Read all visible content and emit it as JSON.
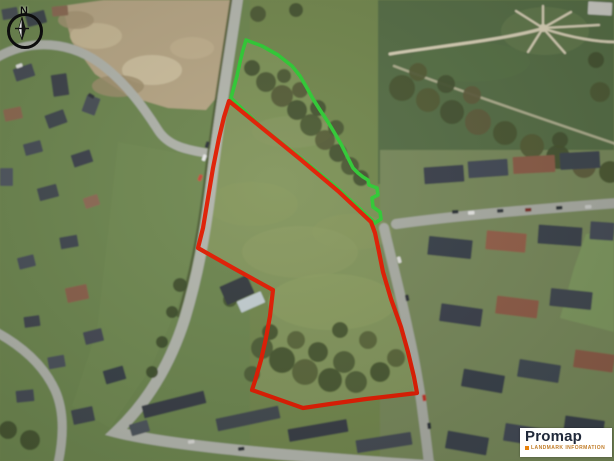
{
  "map": {
    "compass_label": "N",
    "attribution": {
      "brand": "Promap",
      "tagline": "LANDMARK INFORMATION"
    }
  },
  "overlay": {
    "boundaries": [
      {
        "name": "extension-boundary-green",
        "color": "#2ecc33",
        "stroke_width": 3.6,
        "points": [
          [
            246,
            40
          ],
          [
            262,
            46
          ],
          [
            278,
            55
          ],
          [
            292,
            66
          ],
          [
            300,
            76
          ],
          [
            307,
            88
          ],
          [
            313,
            99
          ],
          [
            320,
            110
          ],
          [
            328,
            122
          ],
          [
            334,
            132
          ],
          [
            341,
            144
          ],
          [
            347,
            156
          ],
          [
            353,
            168
          ],
          [
            358,
            173
          ],
          [
            363,
            177
          ],
          [
            368,
            180
          ],
          [
            369,
            185
          ],
          [
            377,
            188
          ],
          [
            378,
            195
          ],
          [
            372,
            198
          ],
          [
            373,
            207
          ],
          [
            380,
            212
          ],
          [
            381,
            219
          ],
          [
            375,
            223
          ],
          [
            336,
            187
          ],
          [
            298,
            156
          ],
          [
            260,
            126
          ],
          [
            231,
            98
          ],
          [
            234,
            87
          ],
          [
            237,
            76
          ],
          [
            240,
            62
          ],
          [
            243,
            50
          ]
        ]
      },
      {
        "name": "site-boundary-red",
        "color": "#e31b00",
        "stroke_width": 4.2,
        "points": [
          [
            229,
            101
          ],
          [
            262,
            128
          ],
          [
            300,
            159
          ],
          [
            338,
            191
          ],
          [
            371,
            222
          ],
          [
            375,
            233
          ],
          [
            379,
            252
          ],
          [
            383,
            272
          ],
          [
            391,
            299
          ],
          [
            401,
            327
          ],
          [
            408,
            352
          ],
          [
            414,
            377
          ],
          [
            417,
            393
          ],
          [
            392,
            396
          ],
          [
            366,
            399
          ],
          [
            330,
            404
          ],
          [
            303,
            408
          ],
          [
            252,
            390
          ],
          [
            255,
            381
          ],
          [
            261,
            360
          ],
          [
            266,
            338
          ],
          [
            270,
            316
          ],
          [
            273,
            290
          ],
          [
            235,
            269
          ],
          [
            198,
            248
          ],
          [
            203,
            228
          ],
          [
            208,
            198
          ],
          [
            213,
            168
          ],
          [
            219,
            138
          ],
          [
            224,
            117
          ]
        ]
      }
    ]
  }
}
